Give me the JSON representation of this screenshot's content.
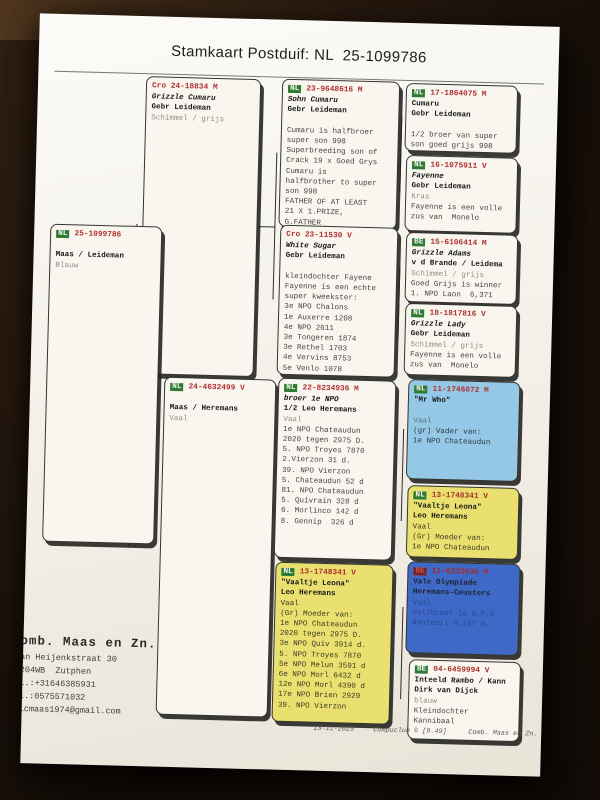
{
  "title": "Stamkaart Postduif: NL  25-1099786",
  "colors": {
    "red": "#b03030",
    "green": "#2d7a33",
    "white": "#f8f6ef",
    "yellow": "#e9e06f",
    "lightblue": "#94c8e6",
    "darkblue": "#3f69c6"
  },
  "boxes": [
    {
      "id": "subject",
      "cc": "NL",
      "ring": "25-1099786",
      "badge": true,
      "variant": "white",
      "lines": [
        {
          "t": "",
          "s": "blank"
        },
        {
          "t": "Maas / Leideman",
          "s": "name"
        },
        {
          "t": "Blauw",
          "s": "gray"
        }
      ]
    },
    {
      "id": "sire",
      "cc": "Cro",
      "ring": "24-18834 M",
      "badge": false,
      "variant": "white",
      "lines": [
        {
          "t": "Grizzle Cumaru",
          "s": "namei"
        },
        {
          "t": "Gebr Leideman",
          "s": "name"
        },
        {
          "t": "Schimmel / grijs",
          "s": "gray"
        }
      ]
    },
    {
      "id": "dam",
      "cc": "NL",
      "ring": "24-4632499 V",
      "badge": true,
      "variant": "white",
      "lines": [
        {
          "t": "",
          "s": "blank"
        },
        {
          "t": "Maas / Heremans",
          "s": "name"
        },
        {
          "t": "Vaal",
          "s": "gray"
        }
      ]
    },
    {
      "id": "g3a",
      "cc": "NL",
      "ring": "23-9648616 M",
      "badge": true,
      "variant": "white",
      "lines": [
        {
          "t": "Sohn Cumaru",
          "s": "namei"
        },
        {
          "t": "Gebr Leideman",
          "s": "name"
        },
        {
          "t": "",
          "s": "blank"
        },
        {
          "t": "Cumaru is halfbroer",
          "s": "body"
        },
        {
          "t": "super son 998",
          "s": "body"
        },
        {
          "t": "Superbreeding son of",
          "s": "body"
        },
        {
          "t": "Crack 19 x Goed Grys",
          "s": "body"
        },
        {
          "t": "Cumaru is",
          "s": "body"
        },
        {
          "t": "halfbrother to super",
          "s": "body"
        },
        {
          "t": "son 998",
          "s": "body"
        },
        {
          "t": "FATHER OF AT LEAST",
          "s": "body"
        },
        {
          "t": "21 X 1.PRIZE,",
          "s": "body"
        },
        {
          "t": "G.FATHER",
          "s": "body"
        }
      ]
    },
    {
      "id": "g3b",
      "cc": "Cro",
      "ring": "23-11530 V",
      "badge": false,
      "variant": "white",
      "lines": [
        {
          "t": "White Sugar",
          "s": "namei"
        },
        {
          "t": "Gebr Leideman",
          "s": "name"
        },
        {
          "t": "",
          "s": "blank"
        },
        {
          "t": "kleindochter Fayene",
          "s": "body"
        },
        {
          "t": "Fayenne is een echte",
          "s": "body"
        },
        {
          "t": "super kweekster:",
          "s": "body"
        },
        {
          "t": "3e NPO Chalons",
          "s": "body"
        },
        {
          "t": "1e Auxerre 1208",
          "s": "body"
        },
        {
          "t": "4e NPO 2611",
          "s": "body"
        },
        {
          "t": "3e Tongeren 1874",
          "s": "body"
        },
        {
          "t": "3e Rethel 1703",
          "s": "body"
        },
        {
          "t": "4e Vervins 8753",
          "s": "body"
        },
        {
          "t": "5e Venlo 1078",
          "s": "body"
        }
      ]
    },
    {
      "id": "g3c",
      "cc": "NL",
      "ring": "22-8234936 M",
      "badge": true,
      "variant": "white",
      "lines": [
        {
          "t": "broer 1e NPO",
          "s": "namei"
        },
        {
          "t": "1/2 Leo Heremans",
          "s": "name"
        },
        {
          "t": "Vaal",
          "s": "gray"
        },
        {
          "t": "1e NPO Chateaudun",
          "s": "body"
        },
        {
          "t": "2020 tegen 2975 D.",
          "s": "body"
        },
        {
          "t": "5. NPO Troyes 7870",
          "s": "body"
        },
        {
          "t": "2.Vierzon 31 d.",
          "s": "body"
        },
        {
          "t": "39. NPO Vierzon",
          "s": "body"
        },
        {
          "t": "5. Chateaudun 52 d",
          "s": "body"
        },
        {
          "t": "81. NPO Chateaudun",
          "s": "body"
        },
        {
          "t": "5. Quivrain 328 d",
          "s": "body"
        },
        {
          "t": "6. Morlinco 142 d",
          "s": "body"
        },
        {
          "t": "8. Gennip  326 d",
          "s": "body"
        }
      ]
    },
    {
      "id": "g3d",
      "cc": "NL",
      "ring": "13-1748341 V",
      "badge": true,
      "variant": "yellow",
      "lines": [
        {
          "t": "\"Vaaltje Leona\"",
          "s": "name"
        },
        {
          "t": "Leo Heremans",
          "s": "name"
        },
        {
          "t": "Vaal",
          "s": "body"
        },
        {
          "t": "(Gr) Moeder van:",
          "s": "body"
        },
        {
          "t": "1e NPO Chateaudun",
          "s": "body"
        },
        {
          "t": "2020 tegen 2975 D.",
          "s": "body"
        },
        {
          "t": "3e NPO Quiv 3914 d.",
          "s": "body"
        },
        {
          "t": "5. NPO Troyes 7870",
          "s": "body"
        },
        {
          "t": "5e NPO Melun 3591 d",
          "s": "body"
        },
        {
          "t": "6e NPO Morl 6432 d",
          "s": "body"
        },
        {
          "t": "12e NPO Morl 4390 d",
          "s": "body"
        },
        {
          "t": "17e NPO Brien 2929",
          "s": "body"
        },
        {
          "t": "39. NPO Vierzon",
          "s": "body"
        }
      ]
    },
    {
      "id": "g4a",
      "cc": "NL",
      "ring": "17-1864075 M",
      "badge": true,
      "variant": "white",
      "lines": [
        {
          "t": "Cumaru",
          "s": "name"
        },
        {
          "t": "Gebr Leideman",
          "s": "name"
        },
        {
          "t": "",
          "s": "blank"
        },
        {
          "t": "1/2 broer van super",
          "s": "body"
        },
        {
          "t": "son goed grijs 998",
          "s": "body"
        }
      ]
    },
    {
      "id": "g4b",
      "cc": "NL",
      "ring": "16-1075911 V",
      "badge": true,
      "variant": "white",
      "lines": [
        {
          "t": "Fayenne",
          "s": "namei"
        },
        {
          "t": "Gebr Leideman",
          "s": "name"
        },
        {
          "t": "Kras",
          "s": "gray"
        },
        {
          "t": "Fayenne is een volle",
          "s": "body"
        },
        {
          "t": "zus van  Monelo",
          "s": "body"
        }
      ]
    },
    {
      "id": "g4c",
      "cc": "BE",
      "ring": "15-6106414 M",
      "badge": true,
      "variant": "white",
      "lines": [
        {
          "t": "Grizzle Adams",
          "s": "namei"
        },
        {
          "t": "v d Brande / Leidema",
          "s": "name"
        },
        {
          "t": "Schimmel / grijs",
          "s": "gray"
        },
        {
          "t": "Goed Grijs is winner",
          "s": "body"
        },
        {
          "t": "1. NPO Laon  6,371",
          "s": "body"
        }
      ]
    },
    {
      "id": "g4d",
      "cc": "NL",
      "ring": "18-1817816 V",
      "badge": true,
      "variant": "white",
      "lines": [
        {
          "t": "Grizzle Lady",
          "s": "namei"
        },
        {
          "t": "Gebr Leideman",
          "s": "name"
        },
        {
          "t": "Schimmel / grijs",
          "s": "gray"
        },
        {
          "t": "Fayenne is een volle",
          "s": "body"
        },
        {
          "t": "zus van  Monelo",
          "s": "body"
        }
      ]
    },
    {
      "id": "g4e",
      "cc": "NL",
      "ring": "11-1746072 M",
      "badge": true,
      "variant": "lightblue",
      "lines": [
        {
          "t": "\"Mr Who\"",
          "s": "name"
        },
        {
          "t": "",
          "s": "blank"
        },
        {
          "t": "Vaal",
          "s": "gray"
        },
        {
          "t": "(gr) Vader van:",
          "s": "body"
        },
        {
          "t": "1e NPO Chateaudun",
          "s": "body"
        }
      ]
    },
    {
      "id": "g4f",
      "cc": "NL",
      "ring": "13-1748341 V",
      "badge": true,
      "variant": "yellow",
      "lines": [
        {
          "t": "\"Vaaltje Leona\"",
          "s": "name"
        },
        {
          "t": "Leo Heremans",
          "s": "name"
        },
        {
          "t": "Vaal",
          "s": "body"
        },
        {
          "t": "(Gr) Moeder van:",
          "s": "body"
        },
        {
          "t": "1e NPO Chateaudun",
          "s": "body"
        }
      ]
    },
    {
      "id": "g4g",
      "cc": "BE",
      "ring": "11-6233636 M",
      "badge": true,
      "variant": "darkblue",
      "lines": [
        {
          "t": "Vale Olympiade",
          "s": "name"
        },
        {
          "t": "Heremans-Ceusters",
          "s": "name"
        },
        {
          "t": "Vaal",
          "s": "faint"
        },
        {
          "t": "Halfbroer 1e N.P.O",
          "s": "faint"
        },
        {
          "t": "Nanteuil 4,157 d.",
          "s": "faint"
        }
      ]
    },
    {
      "id": "g4h",
      "cc": "BE",
      "ring": "04-6459994 V",
      "badge": true,
      "variant": "white",
      "lines": [
        {
          "t": "Inteeld Rambo / Kann",
          "s": "name"
        },
        {
          "t": "Dirk van Dijck",
          "s": "name"
        },
        {
          "t": "blauw",
          "s": "gray"
        },
        {
          "t": "Kleindochter",
          "s": "body"
        },
        {
          "t": "Kannibaal",
          "s": "body"
        }
      ]
    }
  ],
  "contact": {
    "name": "omb. Maas en Zn.",
    "lines": [
      "an Heijenkstraat 30",
      "204WB  Zutphen",
      "l.:+31646385931",
      "l.:0575571032",
      "icmaas1974@gmail.com"
    ]
  },
  "footer": {
    "date": "13-11-2025",
    "app": "Compuclub © [9.49]",
    "owner": "Comb. Maas en Zn."
  }
}
